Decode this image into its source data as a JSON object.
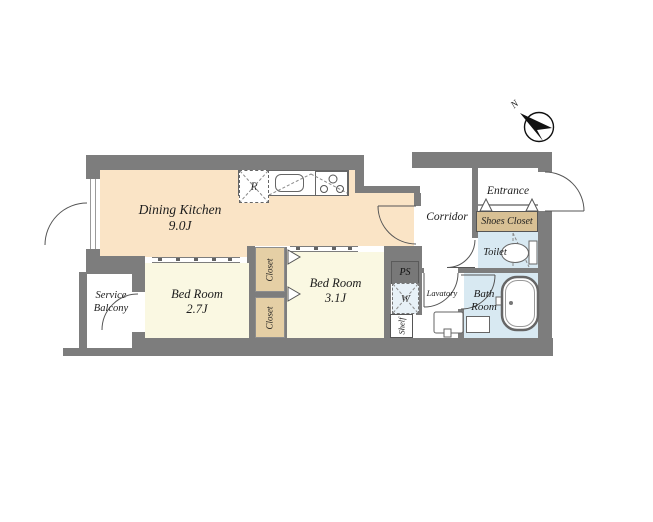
{
  "compass": {
    "north_label": "N"
  },
  "rooms": {
    "dining_kitchen": {
      "name": "Dining Kitchen",
      "area": "9.0J"
    },
    "bed_room_small": {
      "name": "Bed Room",
      "area": "2.7J"
    },
    "bed_room_large": {
      "name": "Bed Room",
      "area": "3.1J"
    },
    "service_balcony": {
      "name": "Service Balcony"
    },
    "corridor": {
      "name": "Corridor"
    },
    "entrance": {
      "name": "Entrance"
    },
    "shoes_closet": {
      "name": "Shoes Closet"
    },
    "toilet": {
      "name": "Toilet"
    },
    "bath_room": {
      "name": "Bath Room"
    },
    "lavatory": {
      "name": "Lavatory"
    },
    "closet_upper": {
      "name": "Closet"
    },
    "closet_lower": {
      "name": "Closet"
    },
    "pipe_space": {
      "name": "PS"
    },
    "washer": {
      "name": "W"
    },
    "shelf": {
      "name": "Shelf"
    },
    "refrigerator": {
      "name": "R"
    }
  },
  "colors": {
    "wall": "#7d7d7d",
    "dining_kitchen_floor": "#fae4c6",
    "bed_room_floor": "#faf8e2",
    "closet_fill": "#e5cfa5",
    "shoes_closet_fill": "#d8c094",
    "wet_area_fill": "#d8e9f2",
    "washer_fill": "#e8f1f7"
  }
}
